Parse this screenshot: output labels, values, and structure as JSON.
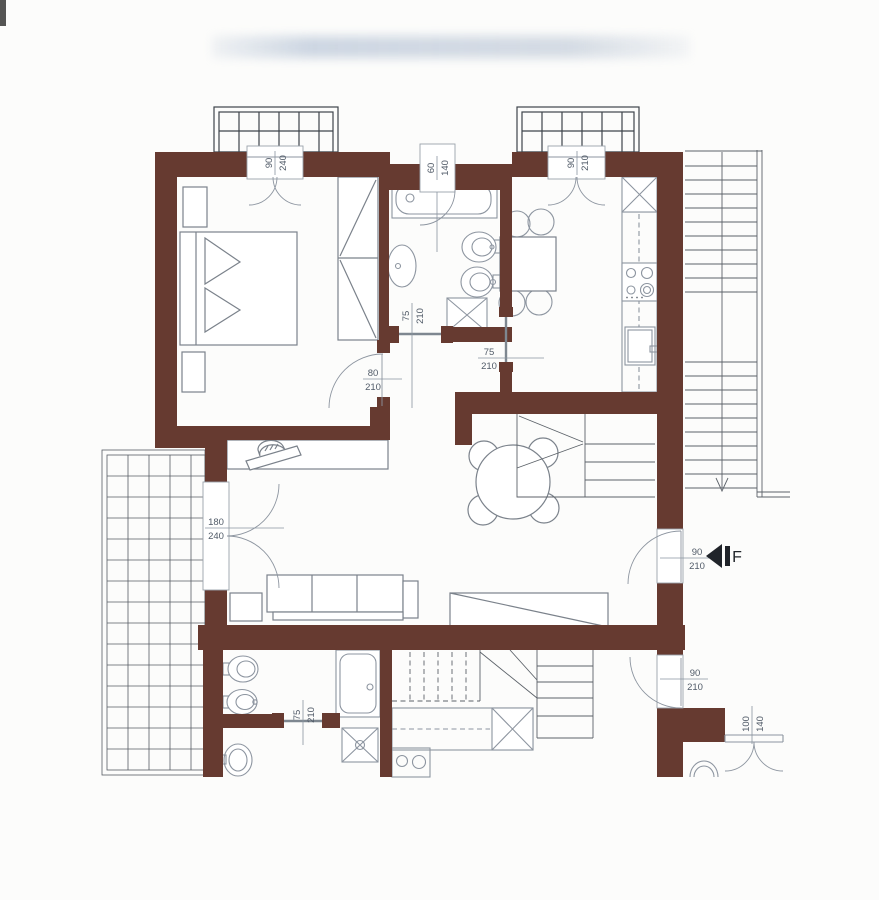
{
  "plan": {
    "marker_letter": "F",
    "dimensions": {
      "bedroom_window": {
        "w": "90",
        "h": "240"
      },
      "bath_window": {
        "w": "60",
        "h": "140"
      },
      "kitchen_window": {
        "w": "90",
        "h": "210"
      },
      "bathroom_door": {
        "w": "75",
        "h": "210"
      },
      "bedroom_door": {
        "w": "80",
        "h": "210"
      },
      "kitchen_door": {
        "w": "75",
        "h": "210"
      },
      "terrace_door": {
        "w": "180",
        "h": "240"
      },
      "entrance_door": {
        "w": "90",
        "h": "210"
      },
      "lower_unit_door": {
        "w": "90",
        "h": "210"
      },
      "lower_bathroom_door": {
        "w": "75",
        "h": "210"
      },
      "lower_window": {
        "w": "100",
        "h": "140"
      }
    }
  },
  "colors": {
    "wall": "#663a30",
    "fixture": "#8d95a0",
    "furniture": "#7b828b",
    "grid": "#464c53",
    "label": "#515b68",
    "label_line": "#8a94a0",
    "paper": "#fcfcfb",
    "marker": "#20242a"
  }
}
